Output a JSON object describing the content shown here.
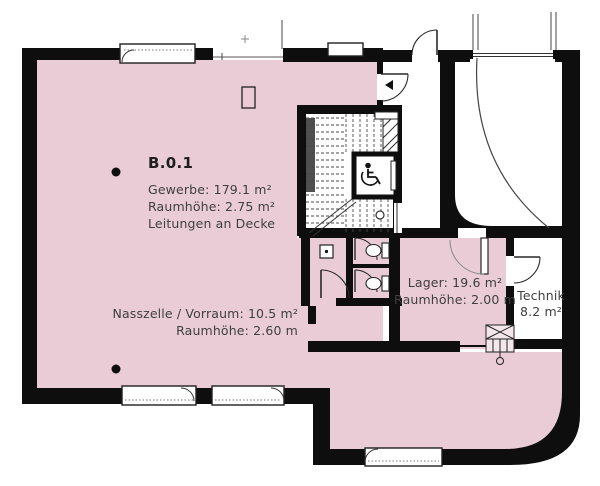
{
  "plan": {
    "rooms": {
      "main": {
        "label": "B.0.1",
        "area": "Gewerbe: 179.1 m²",
        "height": "Raumhöhe: 2.75 m²",
        "note": "Leitungen an Decke"
      },
      "wet": {
        "area": "Nasszelle / Vorraum: 10.5 m²",
        "height": "Raumhöhe: 2.60 m"
      },
      "storage": {
        "area": "Lager: 19.6 m²",
        "height": "Raumhöhe: 2.00 m"
      },
      "tech": {
        "name": "Technik",
        "area": "8.2 m²"
      }
    },
    "colors": {
      "room_fill": "#e9ccd5",
      "wall": "#0e0e0e",
      "text": "#3b3b3b"
    }
  }
}
